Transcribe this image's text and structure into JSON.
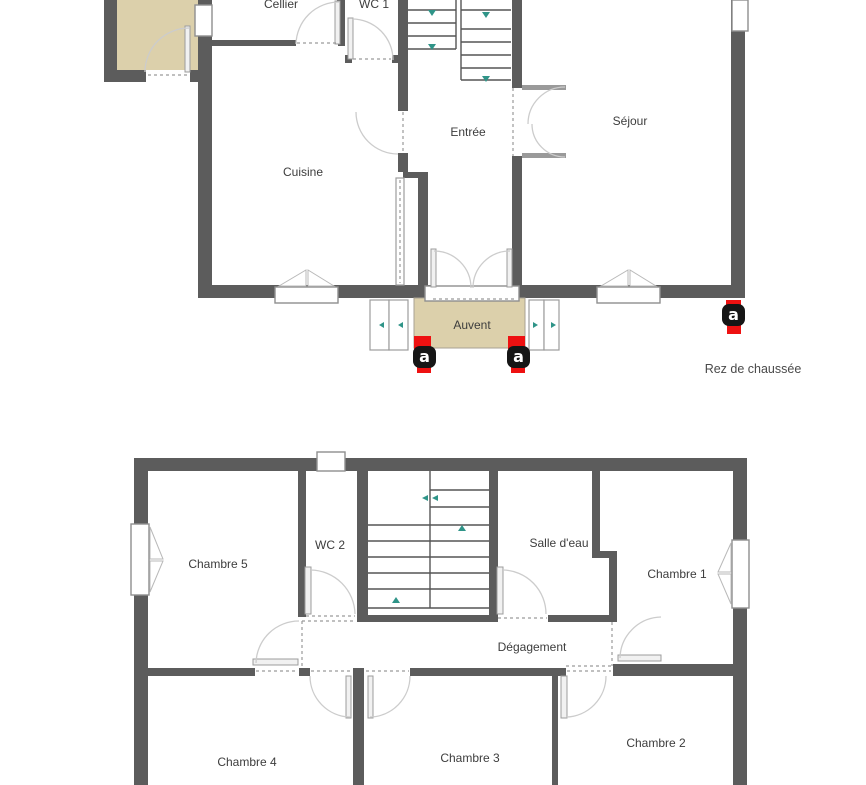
{
  "ground_floor": {
    "caption": "Rez de chaussée",
    "rooms": [
      {
        "label": "Cellier"
      },
      {
        "label": "WC 1"
      },
      {
        "label": "Cuisine"
      },
      {
        "label": "Entrée"
      },
      {
        "label": "Séjour"
      },
      {
        "label": "Auvent"
      }
    ]
  },
  "first_floor": {
    "rooms": [
      {
        "label": "Chambre 5"
      },
      {
        "label": "WC 2"
      },
      {
        "label": "Salle d'eau"
      },
      {
        "label": "Chambre 1"
      },
      {
        "label": "Dégagement"
      },
      {
        "label": "Chambre 4"
      },
      {
        "label": "Chambre 3"
      },
      {
        "label": "Chambre 2"
      }
    ]
  },
  "markers": {
    "letter": "a"
  },
  "colors": {
    "wall": "#5c5c5c",
    "annex_fill": "#dcd0ab",
    "auvent_fill": "#dcd0ab",
    "marker_red": "#ee1111",
    "badge_black": "#161616",
    "stair_arrow_teal": "#2f9488",
    "label_text": "#3d3d3d"
  }
}
